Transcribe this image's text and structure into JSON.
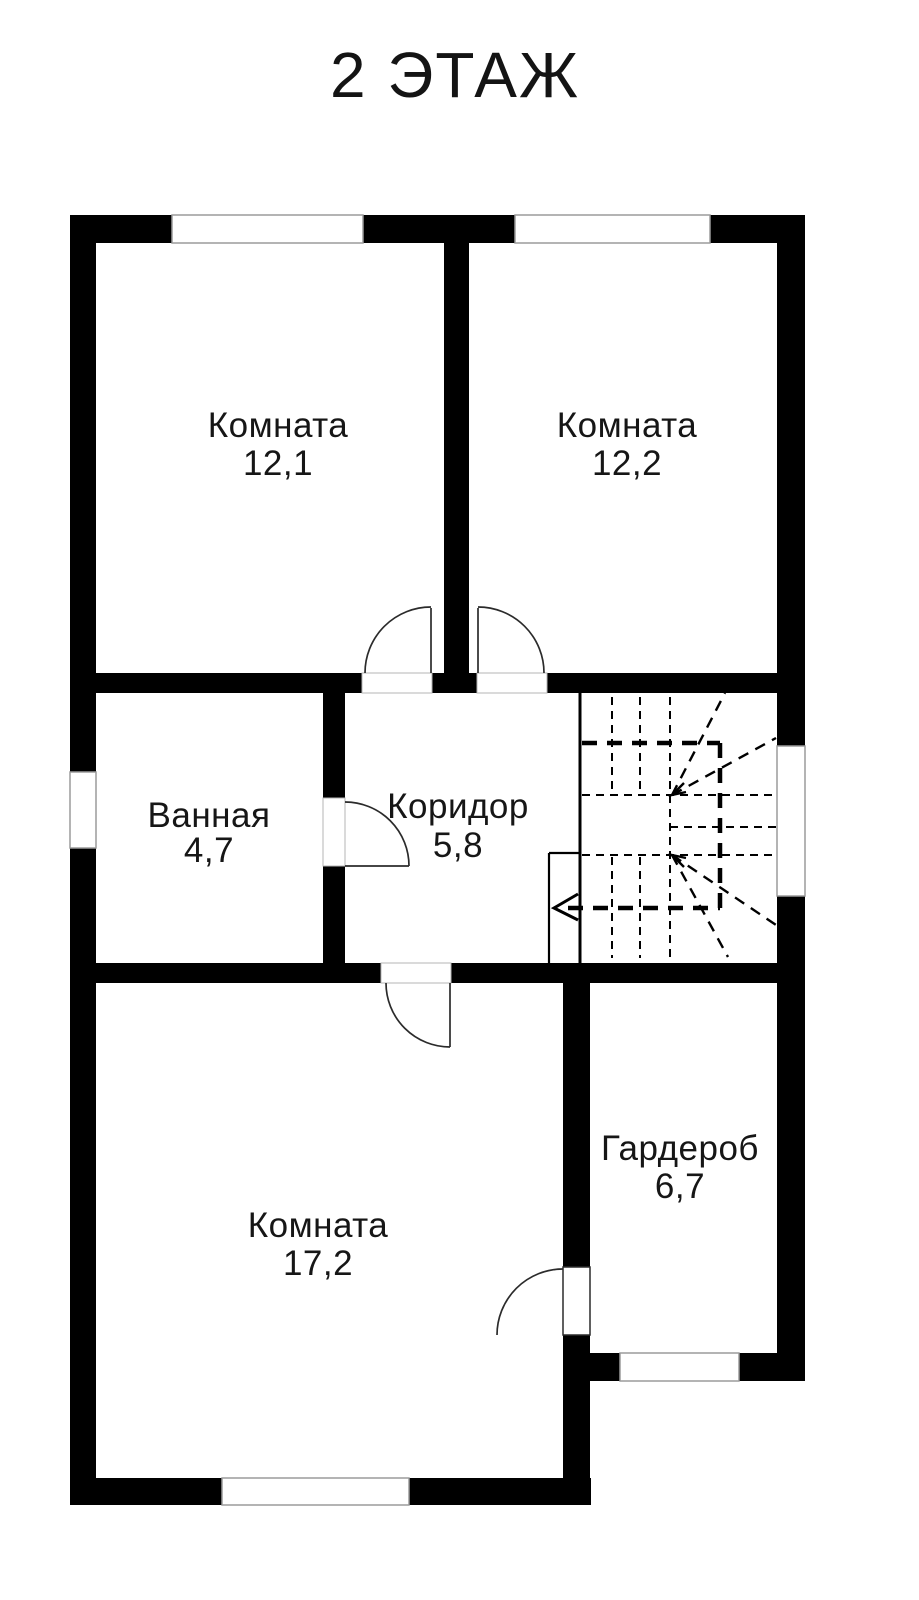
{
  "title": "2 ЭТАЖ",
  "rooms": [
    {
      "id": "room-12-1",
      "label": "Комната",
      "area": "12,1"
    },
    {
      "id": "room-12-2",
      "label": "Комната",
      "area": "12,2"
    },
    {
      "id": "bathroom",
      "label": "Ванная",
      "area": "4,7"
    },
    {
      "id": "corridor",
      "label": "Коридор",
      "area": "5,8"
    },
    {
      "id": "wardrobe",
      "label": "Гардероб",
      "area": "6,7"
    },
    {
      "id": "room-17-2",
      "label": "Комната",
      "area": "17,2"
    }
  ],
  "colors": {
    "background": "#ffffff",
    "wall": "#000000",
    "door_line": "#2b2b2b",
    "window_outline": "#9b9b9b",
    "text": "#161616"
  }
}
